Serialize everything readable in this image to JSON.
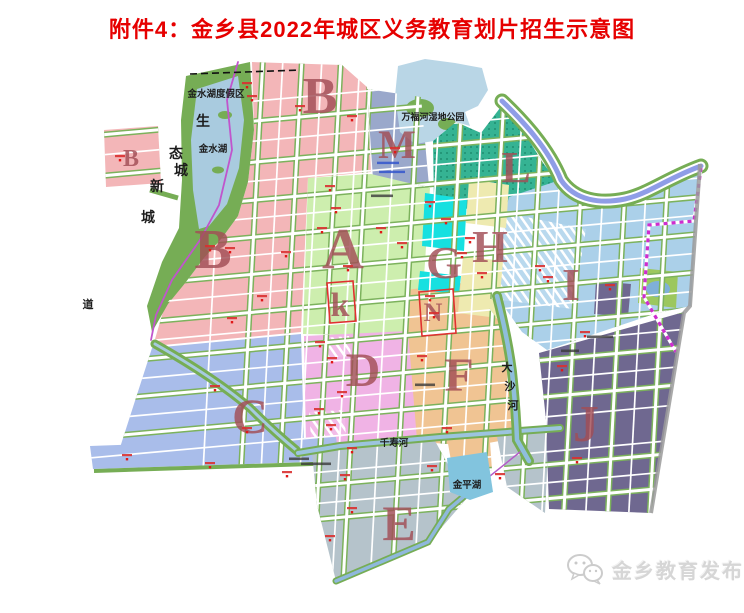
{
  "title": "附件4：金乡县2022年城区义务教育划片招生示意图",
  "palette": {
    "title_red": "#e60000",
    "letter": "#a24e56",
    "zone_pink": "#f3b6b8",
    "zone_blue_gray": "#9aa8cb",
    "zone_teal": "#35b393",
    "zone_light_green": "#cdeeae",
    "zone_cyan": "#17e0e0",
    "zone_yellow": "#eeeab0",
    "zone_light_blue": "#abd0e9",
    "zone_tan": "#f0c493",
    "zone_violet": "#f0b3e5",
    "zone_periwinkle": "#a9bdea",
    "zone_gray": "#b5c3cb",
    "zone_dark_purple": "#6f6890",
    "park_green": "#76ad55",
    "water_blue": "#a9cbdf",
    "boundary_red": "#e03030",
    "boundary_magenta": "#ce2dce",
    "river_violet": "#8f9de7"
  },
  "zone_letters": [
    {
      "t": "B"
    },
    {
      "t": "M"
    },
    {
      "t": "L"
    },
    {
      "t": "B"
    },
    {
      "t": "B"
    },
    {
      "t": "A"
    },
    {
      "t": "H"
    },
    {
      "t": "G"
    },
    {
      "t": "k"
    },
    {
      "t": "N"
    },
    {
      "t": "I"
    },
    {
      "t": "D"
    },
    {
      "t": "F"
    },
    {
      "t": "C"
    },
    {
      "t": "J"
    },
    {
      "t": "E"
    }
  ],
  "map_labels": {
    "resort": "金水湖度假区",
    "lake_jinshui": "金水湖",
    "wetland": "万福河湿地公园",
    "river_qianshou": "千寿河",
    "lake_jinping": "金平湖",
    "dao": "道",
    "eco": [
      "生",
      "态",
      "城"
    ],
    "newtown": [
      "新",
      "城"
    ],
    "dasha": [
      "大",
      "沙",
      "河"
    ]
  },
  "watermark": {
    "name": "金乡教育发布"
  }
}
